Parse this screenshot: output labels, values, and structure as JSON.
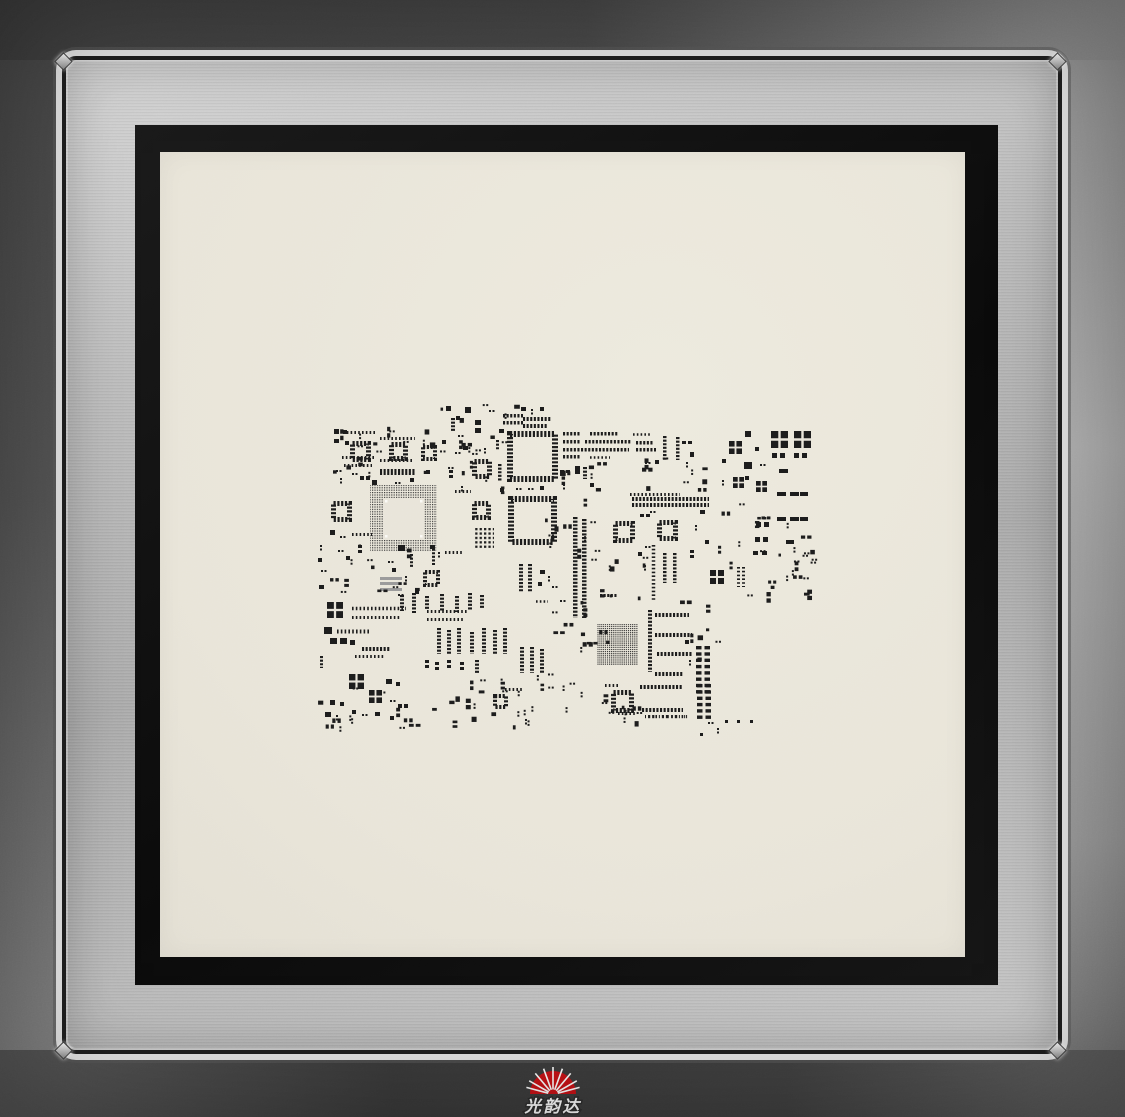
{
  "logo": {
    "text": "光韵达",
    "sun_color": "#c91216",
    "text_color": "#ffffff"
  },
  "colors": {
    "frame_outer_dark": "#454545",
    "frame_outer_light": "#b2b2b2",
    "frame_silver": "#bdbdbd",
    "bevel_highlight": "#e3e3e3",
    "adhesive_black": "#0d0d0d",
    "foil_cream": "#e9e5da",
    "aperture": "#1c1c1c",
    "logo_red": "#c91216"
  },
  "stencil_pattern": {
    "aperture_color": "#1c1c1c",
    "foil_inner": "#e9e5da",
    "components": [
      [
        "ch",
        503,
        414,
        20,
        3.5
      ],
      [
        "ch",
        503,
        421,
        20,
        3.5
      ],
      [
        "ch",
        523,
        417,
        28,
        4
      ],
      [
        "ch",
        523,
        424,
        25,
        4
      ],
      [
        "rc",
        465,
        407,
        6,
        6
      ],
      [
        "rc",
        456,
        416,
        4,
        4
      ],
      [
        "rc",
        446,
        406,
        5,
        5
      ],
      [
        "cv",
        451,
        418,
        4,
        13
      ],
      [
        "d2h",
        458,
        435
      ],
      [
        "rc",
        442,
        440,
        4,
        4
      ],
      [
        "r2v",
        475,
        420,
        6,
        5,
        3
      ],
      [
        "rc",
        499,
        429,
        5,
        4
      ],
      [
        "d2h",
        489,
        410
      ],
      [
        "cv",
        496,
        440,
        3,
        10
      ],
      [
        "rc",
        521,
        407,
        5,
        4
      ],
      [
        "d2v",
        531,
        409
      ],
      [
        "rc",
        540,
        407,
        4,
        4
      ],
      [
        "arr",
        343,
        431,
        33,
        3
      ],
      [
        "arr",
        380,
        437,
        35,
        3
      ],
      [
        "rc",
        334,
        429,
        5,
        5
      ],
      [
        "rc",
        343,
        430,
        4,
        4
      ],
      [
        "rc",
        334,
        439,
        5,
        4
      ],
      [
        "rc",
        345,
        441,
        4,
        4
      ],
      [
        "qfp",
        350,
        441,
        21,
        5
      ],
      [
        "qfp",
        389,
        442,
        19,
        5
      ],
      [
        "qfp",
        421,
        445,
        16,
        4
      ],
      [
        "arr",
        342,
        456,
        33,
        3
      ],
      [
        "arr",
        380,
        459,
        32,
        3
      ],
      [
        "arr",
        344,
        464,
        28,
        3
      ],
      [
        "ch",
        380,
        469,
        35,
        6
      ],
      [
        "d2h",
        336,
        470
      ],
      [
        "d2h",
        352,
        473
      ],
      [
        "r2h",
        360,
        476,
        4,
        4,
        2
      ],
      [
        "d2v",
        340,
        478
      ],
      [
        "rc",
        372,
        480,
        5,
        5
      ],
      [
        "d2h",
        395,
        482
      ],
      [
        "rc",
        410,
        478,
        4,
        4
      ],
      [
        "rc",
        426,
        470,
        4,
        4
      ],
      [
        "qfpg",
        370,
        485,
        67,
        13
      ],
      [
        "qfp",
        472,
        459,
        20,
        5
      ],
      [
        "qfp",
        472,
        501,
        19,
        5
      ],
      [
        "cv",
        498,
        464,
        3.5,
        18
      ],
      [
        "rc",
        500,
        488,
        4,
        4
      ],
      [
        "d2v",
        461,
        486
      ],
      [
        "arr",
        455,
        490,
        16,
        3
      ],
      [
        "r2v",
        449,
        470,
        4,
        3,
        2
      ],
      [
        "d2h",
        455,
        452
      ],
      [
        "rc",
        463,
        446,
        5,
        4
      ],
      [
        "d2v",
        484,
        448
      ],
      [
        "qfp",
        507,
        431,
        51,
        6
      ],
      [
        "qfp",
        508,
        496,
        49,
        6
      ],
      [
        "d2h",
        516,
        488
      ],
      [
        "d2h",
        528,
        488
      ],
      [
        "rc",
        540,
        486,
        4,
        4
      ],
      [
        "r2h",
        560,
        470,
        4,
        3,
        2
      ],
      [
        "rc",
        575,
        466,
        5,
        8
      ],
      [
        "cv",
        583,
        467,
        4,
        12
      ],
      [
        "d2v",
        563,
        484
      ],
      [
        "rc",
        590,
        483,
        4,
        4
      ],
      [
        "cv",
        573,
        517,
        4.5,
        101
      ],
      [
        "cv",
        582,
        519,
        4.5,
        99
      ],
      [
        "ch",
        563,
        432,
        18,
        3.5
      ],
      [
        "ch",
        590,
        432,
        28,
        3.5
      ],
      [
        "arr",
        633,
        433,
        18,
        2.5
      ],
      [
        "ch",
        563,
        440,
        18,
        3.5
      ],
      [
        "ch",
        585,
        440,
        46,
        3.5
      ],
      [
        "ch",
        636,
        441,
        18,
        3.5
      ],
      [
        "ch",
        563,
        448,
        66,
        3.5
      ],
      [
        "ch",
        636,
        448,
        20,
        3.5
      ],
      [
        "ch",
        563,
        455,
        18,
        3.5
      ],
      [
        "arr",
        590,
        456,
        20,
        2.5
      ],
      [
        "cv",
        663,
        436,
        3.5,
        24
      ],
      [
        "cv",
        676,
        437,
        3.5,
        23
      ],
      [
        "d2h",
        645,
        462
      ],
      [
        "rc",
        655,
        460,
        4,
        4
      ],
      [
        "r2h",
        682,
        441,
        4,
        3,
        2
      ],
      [
        "rc",
        690,
        452,
        4,
        5
      ],
      [
        "d2v",
        686,
        462
      ],
      [
        "arr",
        630,
        493,
        50,
        3
      ],
      [
        "ch",
        632,
        497,
        77,
        4
      ],
      [
        "ch",
        632,
        503,
        77,
        4
      ],
      [
        "qfp",
        613,
        521,
        22,
        5
      ],
      [
        "qfp",
        657,
        520,
        21,
        5
      ],
      [
        "q4",
        710,
        570,
        14
      ],
      [
        "av",
        652,
        545,
        3.5,
        55
      ],
      [
        "cv",
        663,
        553,
        3.5,
        30
      ],
      [
        "cv",
        673,
        553,
        3.5,
        30
      ],
      [
        "r2h",
        640,
        514,
        4,
        3,
        2
      ],
      [
        "d2h",
        650,
        511
      ],
      [
        "rc",
        700,
        510,
        5,
        4
      ],
      [
        "d2v",
        695,
        525
      ],
      [
        "rc",
        705,
        540,
        4,
        4
      ],
      [
        "r2v",
        690,
        550,
        4,
        3,
        2
      ],
      [
        "d2h",
        645,
        546
      ],
      [
        "rc",
        638,
        552,
        4,
        4
      ],
      [
        "ch",
        600,
        594,
        18,
        3
      ],
      [
        "q4",
        729,
        441,
        13
      ],
      [
        "q4",
        733,
        477,
        11
      ],
      [
        "q4",
        756,
        481,
        11
      ],
      [
        "q4",
        771,
        431,
        17
      ],
      [
        "q4",
        794,
        431,
        17
      ],
      [
        "r2h",
        772,
        453,
        5,
        5,
        3
      ],
      [
        "r2h",
        794,
        453,
        5,
        5,
        3
      ],
      [
        "rc",
        745,
        431,
        6,
        6
      ],
      [
        "rc",
        755,
        447,
        4,
        4
      ],
      [
        "rc",
        722,
        459,
        4,
        4
      ],
      [
        "rc",
        744,
        462,
        8,
        7
      ],
      [
        "d2h",
        760,
        464
      ],
      [
        "rc",
        779,
        469,
        9,
        4
      ],
      [
        "rc",
        745,
        476,
        4,
        4
      ],
      [
        "d2v",
        722,
        480
      ],
      [
        "r2h",
        777,
        492,
        9,
        4,
        4
      ],
      [
        "rc",
        800,
        492,
        8,
        4
      ],
      [
        "r2h",
        777,
        517,
        9,
        4,
        4
      ],
      [
        "rc",
        800,
        517,
        8,
        4
      ],
      [
        "r2h",
        756,
        522,
        5,
        5,
        3
      ],
      [
        "r2h",
        755,
        537,
        5,
        5,
        3
      ],
      [
        "rc",
        786,
        540,
        8,
        4
      ],
      [
        "av",
        737,
        567,
        3,
        20
      ],
      [
        "av",
        742,
        567,
        3,
        20
      ],
      [
        "r2h",
        753,
        551,
        5,
        4,
        4
      ],
      [
        "bga",
        597,
        624,
        41,
        41
      ],
      [
        "cv",
        648,
        610,
        4,
        62
      ],
      [
        "ch",
        655,
        613,
        34,
        4
      ],
      [
        "ch",
        655,
        633,
        37,
        4
      ],
      [
        "ch",
        657,
        652,
        35,
        4
      ],
      [
        "ch",
        655,
        672,
        28,
        4
      ],
      [
        "lad",
        696,
        646,
        8,
        6.3
      ],
      [
        "lad",
        697,
        684,
        6,
        6.3
      ],
      [
        "rc",
        685,
        640,
        4,
        4
      ],
      [
        "d2v",
        689,
        660
      ],
      [
        "qfp",
        611,
        690,
        23,
        5
      ],
      [
        "ch",
        640,
        685,
        43,
        4
      ],
      [
        "ch",
        642,
        708,
        41,
        4
      ],
      [
        "txt",
        645,
        715,
        44
      ],
      [
        "arr",
        618,
        712,
        19,
        3
      ],
      [
        "arr",
        605,
        684,
        14,
        3
      ],
      [
        "d2h",
        708,
        722
      ],
      [
        "rc",
        725,
        720,
        3,
        3
      ],
      [
        "rc",
        737,
        720,
        3,
        3
      ],
      [
        "rc",
        750,
        720,
        3,
        3
      ],
      [
        "d2v",
        717,
        728
      ],
      [
        "rc",
        700,
        733,
        3,
        3
      ],
      [
        "qfp",
        331,
        501,
        21,
        5
      ],
      [
        "rc",
        330,
        530,
        5,
        5
      ],
      [
        "d2h",
        340,
        536
      ],
      [
        "arr",
        352,
        533,
        20,
        3
      ],
      [
        "r2v",
        358,
        545,
        4,
        3,
        2
      ],
      [
        "d2h",
        338,
        550
      ],
      [
        "rc",
        346,
        556,
        4,
        4
      ],
      [
        "gr",
        380,
        577,
        22,
        3
      ],
      [
        "gr",
        380,
        582,
        22,
        3
      ],
      [
        "gr",
        380,
        588,
        22,
        3
      ],
      [
        "qfp",
        423,
        570,
        17,
        4
      ],
      [
        "cv",
        410,
        554,
        3,
        14
      ],
      [
        "rc",
        398,
        545,
        7,
        6
      ],
      [
        "d2h",
        388,
        561
      ],
      [
        "rc",
        392,
        568,
        4,
        4
      ],
      [
        "d2v",
        405,
        576
      ],
      [
        "rc",
        415,
        590,
        4,
        4
      ],
      [
        "d2h",
        398,
        594
      ],
      [
        "rc",
        430,
        545,
        5,
        4
      ],
      [
        "d2v",
        438,
        552
      ],
      [
        "d2v",
        320,
        545
      ],
      [
        "rc",
        318,
        558,
        4,
        4
      ],
      [
        "d2h",
        321,
        570
      ],
      [
        "rc",
        319,
        585,
        5,
        4
      ],
      [
        "pga",
        474,
        528,
        20,
        20
      ],
      [
        "arr",
        445,
        551,
        17,
        3
      ],
      [
        "cv",
        432,
        545,
        3,
        20
      ],
      [
        "cv",
        519,
        564,
        4,
        28
      ],
      [
        "cv",
        528,
        564,
        4,
        28
      ],
      [
        "rc",
        540,
        570,
        5,
        4
      ],
      [
        "d2v",
        548,
        576
      ],
      [
        "rc",
        538,
        582,
        4,
        4
      ],
      [
        "d2h",
        552,
        586
      ],
      [
        "arr",
        536,
        600,
        12,
        2.5
      ],
      [
        "d2h",
        560,
        600
      ],
      [
        "cv",
        400,
        595,
        4,
        16
      ],
      [
        "cv",
        412,
        593,
        4,
        20
      ],
      [
        "cv",
        425,
        596,
        4,
        14
      ],
      [
        "cv",
        440,
        594,
        4,
        18
      ],
      [
        "cv",
        455,
        596,
        4,
        16
      ],
      [
        "cv",
        468,
        593,
        4,
        18
      ],
      [
        "cv",
        480,
        595,
        4,
        14
      ],
      [
        "arr",
        427,
        610,
        40,
        3
      ],
      [
        "arr",
        427,
        618,
        36,
        3
      ],
      [
        "cv",
        437,
        628,
        4,
        26
      ],
      [
        "cv",
        447,
        630,
        4,
        24
      ],
      [
        "cv",
        457,
        628,
        4,
        26
      ],
      [
        "cv",
        470,
        632,
        4,
        22
      ],
      [
        "cv",
        482,
        628,
        4,
        26
      ],
      [
        "cv",
        493,
        630,
        4,
        24
      ],
      [
        "cv",
        503,
        628,
        4,
        26
      ],
      [
        "cv",
        520,
        647,
        4,
        26
      ],
      [
        "cv",
        530,
        647,
        4,
        26
      ],
      [
        "cv",
        540,
        649,
        4,
        24
      ],
      [
        "cv",
        475,
        660,
        4,
        14
      ],
      [
        "r2v",
        425,
        660,
        4,
        3,
        2
      ],
      [
        "r2v",
        435,
        662,
        4,
        3,
        2
      ],
      [
        "r2v",
        447,
        660,
        4,
        3,
        2
      ],
      [
        "r2v",
        460,
        662,
        4,
        3,
        2
      ],
      [
        "q4",
        327,
        602,
        16
      ],
      [
        "arr",
        352,
        607,
        54,
        3.5
      ],
      [
        "arr",
        352,
        616,
        48,
        3
      ],
      [
        "rc",
        324,
        627,
        8,
        7
      ],
      [
        "arr",
        337,
        630,
        32,
        4
      ],
      [
        "r2h",
        330,
        638,
        7,
        6,
        3
      ],
      [
        "rc",
        350,
        640,
        5,
        5
      ],
      [
        "ch",
        362,
        647,
        28,
        4
      ],
      [
        "arr",
        355,
        655,
        30,
        3
      ],
      [
        "cv",
        320,
        656,
        3,
        12
      ],
      [
        "q4",
        349,
        674,
        15
      ],
      [
        "q4",
        369,
        690,
        13
      ],
      [
        "rc",
        386,
        679,
        6,
        5
      ],
      [
        "rc",
        396,
        682,
        4,
        4
      ],
      [
        "d2h",
        390,
        700
      ],
      [
        "r2h",
        398,
        704,
        4,
        4,
        2
      ],
      [
        "rc",
        330,
        700,
        5,
        5
      ],
      [
        "rc",
        340,
        702,
        4,
        4
      ],
      [
        "rc",
        325,
        712,
        6,
        5
      ],
      [
        "d2v",
        336,
        715
      ],
      [
        "rc",
        352,
        710,
        4,
        4
      ],
      [
        "d2h",
        362,
        714
      ],
      [
        "rc",
        375,
        712,
        5,
        4
      ],
      [
        "rc",
        390,
        716,
        4,
        4
      ],
      [
        "qfp",
        493,
        694,
        15,
        4
      ],
      [
        "arr",
        505,
        688,
        18,
        3
      ]
    ],
    "scatter": [
      [
        333,
        424,
        100,
        58,
        16,
        7
      ],
      [
        440,
        404,
        80,
        48,
        10,
        11
      ],
      [
        560,
        462,
        58,
        38,
        8,
        17
      ],
      [
        642,
        456,
        68,
        38,
        9,
        19
      ],
      [
        718,
        498,
        92,
        100,
        20,
        23
      ],
      [
        330,
        540,
        88,
        52,
        12,
        29
      ],
      [
        545,
        515,
        55,
        48,
        11,
        37
      ],
      [
        552,
        598,
        58,
        55,
        11,
        41
      ],
      [
        470,
        672,
        100,
        26,
        12,
        43
      ],
      [
        432,
        690,
        215,
        36,
        26,
        47
      ],
      [
        600,
        556,
        48,
        44,
        9,
        53
      ],
      [
        680,
        600,
        38,
        58,
        7,
        59
      ],
      [
        760,
        545,
        55,
        55,
        10,
        61
      ],
      [
        318,
        686,
        100,
        42,
        12,
        67
      ],
      [
        448,
        440,
        55,
        52,
        8,
        71
      ]
    ]
  }
}
